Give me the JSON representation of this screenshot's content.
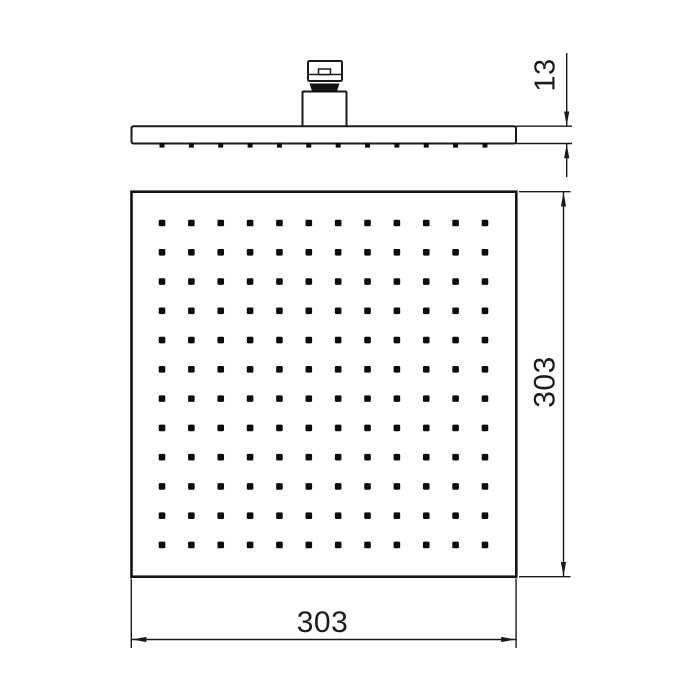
{
  "page": {
    "background_color": "#ffffff",
    "line_color": "#1a1a1a"
  },
  "drawing": {
    "views": {
      "side_view": {
        "name": "side-profile-view",
        "nozzle_count": 12,
        "thickness_dimension": {
          "value": "13"
        }
      },
      "face_view": {
        "name": "spray-face-view",
        "nozzle_grid": {
          "rows": 12,
          "cols": 12
        },
        "height_dimension": {
          "value": "303"
        },
        "width_dimension": {
          "value": "303"
        }
      }
    }
  }
}
